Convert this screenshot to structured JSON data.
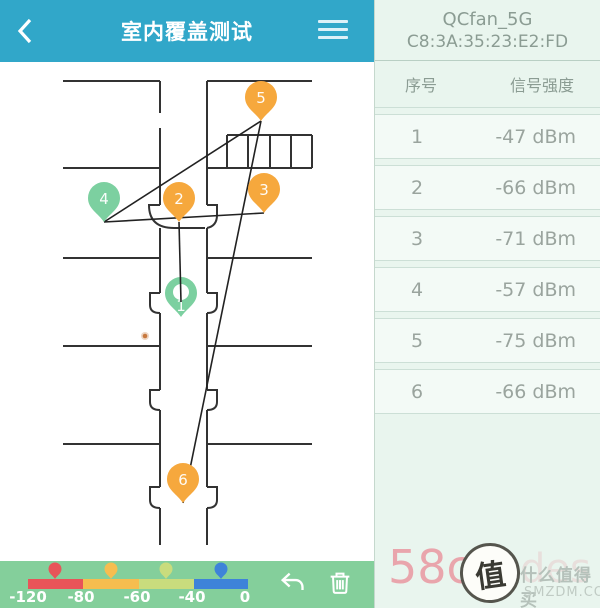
{
  "header": {
    "title": "室内覆盖测试"
  },
  "icons": {
    "back": "chevron-left",
    "menu": "hamburger",
    "undo": "undo-arrow",
    "delete": "trash-can"
  },
  "network": {
    "ssid": "QCfan_5G",
    "mac": "C8:3A:35:23:E2:FD"
  },
  "table": {
    "col_index": "序号",
    "col_signal": "信号强度",
    "rows": [
      {
        "index": "1",
        "signal": "-47 dBm"
      },
      {
        "index": "2",
        "signal": "-66 dBm"
      },
      {
        "index": "3",
        "signal": "-71 dBm"
      },
      {
        "index": "4",
        "signal": "-57 dBm"
      },
      {
        "index": "5",
        "signal": "-75 dBm"
      },
      {
        "index": "6",
        "signal": "-66 dBm"
      }
    ]
  },
  "map": {
    "pins": [
      {
        "label": "1",
        "color": "#7cd0a0"
      },
      {
        "label": "2",
        "color": "#f6a83d"
      },
      {
        "label": "3",
        "color": "#f6a83d"
      },
      {
        "label": "4",
        "color": "#7cd0a0"
      },
      {
        "label": "5",
        "color": "#f6a83d"
      },
      {
        "label": "6",
        "color": "#f6a83d"
      }
    ]
  },
  "legend": {
    "ticks": [
      "-120",
      "-80",
      "-60",
      "-40",
      "0"
    ],
    "segments": [
      {
        "color": "#e85459"
      },
      {
        "color": "#f6bd4f"
      },
      {
        "color": "#c9dc7d"
      },
      {
        "color": "#3e83d9"
      }
    ]
  },
  "watermark": {
    "red_text": "58c",
    "faint_text": "des",
    "logo_char": "值",
    "line1": "什么值得买",
    "line2": "SMZDM.COM"
  }
}
